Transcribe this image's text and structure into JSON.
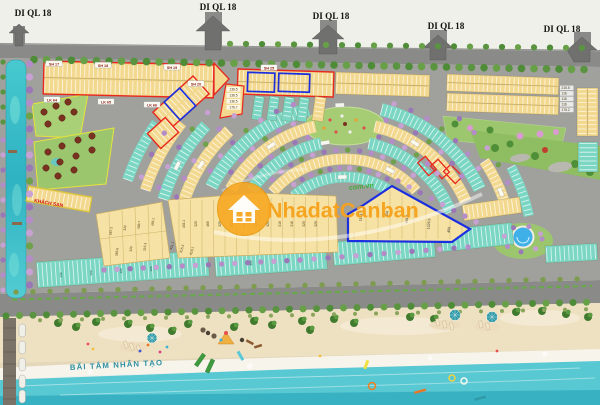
{
  "map": {
    "exits": {
      "label": "DI QL 18"
    },
    "labels": {
      "beach": "BÃI TẮM NHÂN TẠO",
      "hotel": "KHÁCH SẠN"
    },
    "watermark": {
      "brand": "NhadatCanban",
      "domain": "com.vn"
    },
    "blocks": {
      "sh17": "SH 17",
      "sh18": "SH 18",
      "sh19": "SH 19",
      "sh20": "SH 20",
      "sh25": "SH 25",
      "lk64": "LK 64",
      "lk65": "LK 65",
      "lk66": "LK 66"
    },
    "plot_areas": {
      "column_a": [
        "136.5",
        "136.5",
        "136.5",
        "176.7"
      ],
      "east_column": [
        "215.5",
        "116",
        "116",
        "116",
        "175.2"
      ],
      "center_row": [
        "433.1",
        "320",
        "469",
        "320",
        "393.9",
        "441.2",
        "320",
        "320",
        "319",
        "318",
        "320",
        "320"
      ],
      "center_row2": [
        "431.1",
        "315.3",
        "310.1"
      ],
      "west_cluster": [
        "567.2",
        "320",
        "488.7",
        "455.1",
        "355.6",
        "320",
        "315.3"
      ],
      "blue_cluster": [
        "1141.5",
        "608",
        "441.5",
        "1025.5",
        "458"
      ],
      "south_row": [
        "120",
        "120",
        "120",
        "120",
        "320"
      ]
    },
    "colors": {
      "highlight_red": "#e8281e",
      "highlight_blue": "#1b2fe0",
      "house_yellow": "#f3d98f",
      "house_teal": "#7bd7c4",
      "watermark_orange": "#f7a21a",
      "watermark_green": "#3faa35",
      "sea": "#58c8d2",
      "sand": "#eee1c2",
      "canal": "#3fc0c8",
      "park_green": "#9cc66e"
    }
  }
}
